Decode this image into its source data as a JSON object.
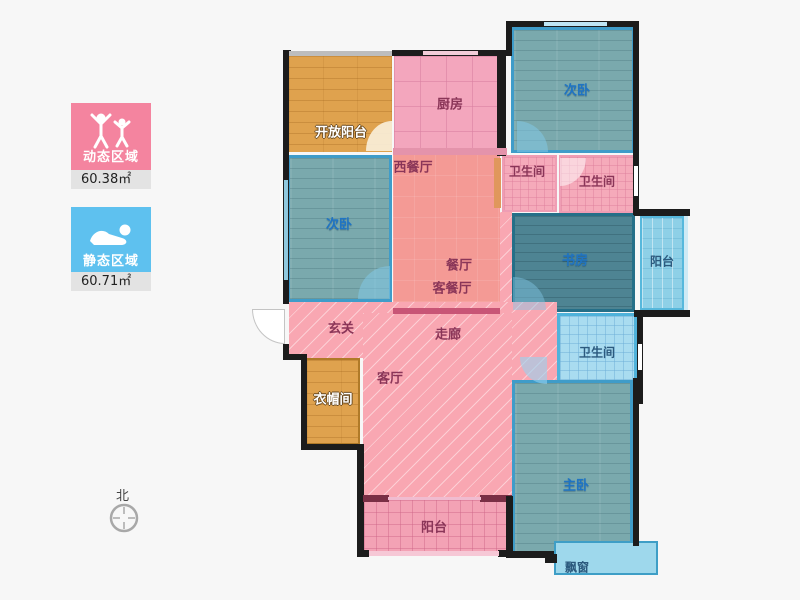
{
  "legend": {
    "dynamic": {
      "label": "动态区域",
      "area": "60.38㎡",
      "color": "#f4849f",
      "icon": "dancing-people-icon"
    },
    "static": {
      "label": "静态区域",
      "area": "60.71㎡",
      "color": "#5ec1ef",
      "icon": "sleeping-person-icon"
    }
  },
  "compass": {
    "label": "北"
  },
  "colors": {
    "wall": "#1c1c1c",
    "wood_orange": "#dfa24e",
    "wood_teal": "#7aa9ad",
    "study_teal": "#4e8493",
    "kitchen_pink": "#f3a6bd",
    "salmon_dining": "#f49a95",
    "corridor_pink": "#f9a7b2",
    "balcony_blue": "#8ed0e7",
    "bathroom_blue": "#a9dcf0"
  },
  "rooms": [
    {
      "id": "open-balcony",
      "label": "开放阳台"
    },
    {
      "id": "kitchen",
      "label": "厨房"
    },
    {
      "id": "bedroom-2-top",
      "label": "次卧"
    },
    {
      "id": "bathroom-1",
      "label": "卫生间"
    },
    {
      "id": "bathroom-2",
      "label": "卫生间"
    },
    {
      "id": "west-dining",
      "label": "西餐厅"
    },
    {
      "id": "bedroom-2-left",
      "label": "次卧"
    },
    {
      "id": "dining",
      "label": "餐厅"
    },
    {
      "id": "living-dining",
      "label": "客餐厅"
    },
    {
      "id": "study",
      "label": "书房"
    },
    {
      "id": "balcony-right",
      "label": "阳台"
    },
    {
      "id": "entry",
      "label": "玄关"
    },
    {
      "id": "corridor",
      "label": "走廊"
    },
    {
      "id": "bathroom-3",
      "label": "卫生间"
    },
    {
      "id": "cloakroom",
      "label": "衣帽间"
    },
    {
      "id": "living-room",
      "label": "客厅"
    },
    {
      "id": "master-bedroom",
      "label": "主卧"
    },
    {
      "id": "balcony-bottom",
      "label": "阳台"
    },
    {
      "id": "bay-window",
      "label": "飘窗"
    }
  ]
}
